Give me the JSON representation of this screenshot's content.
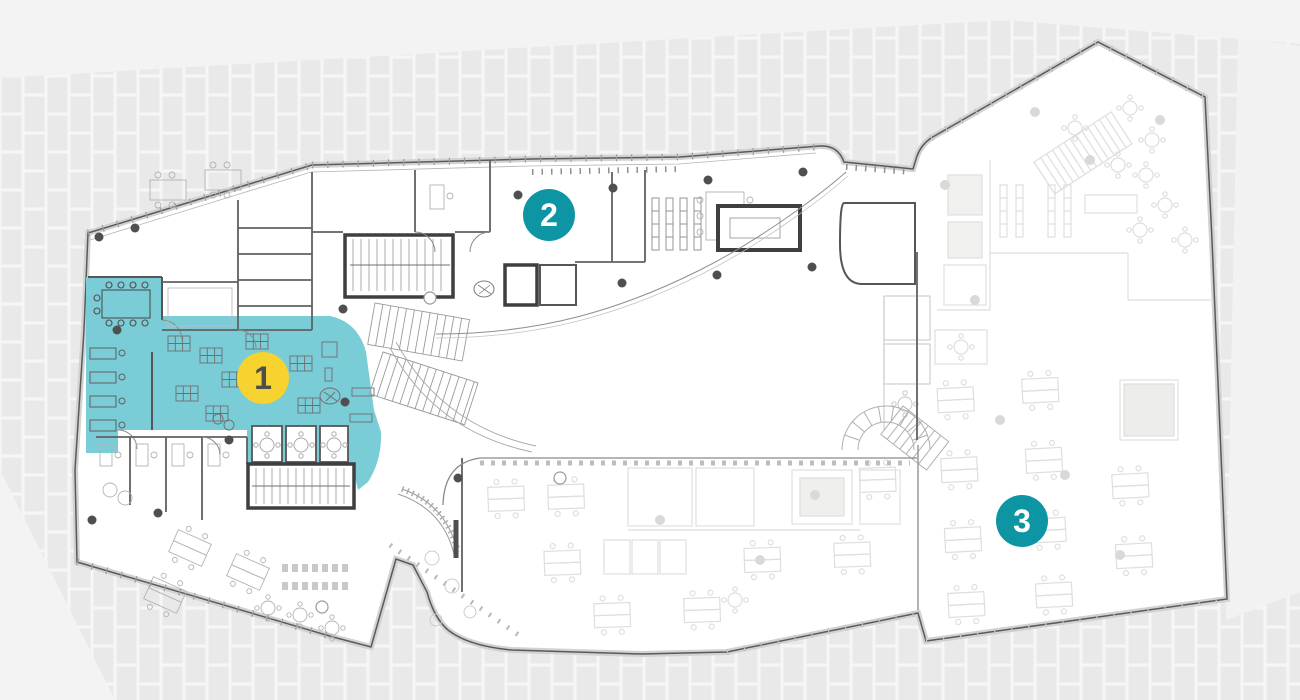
{
  "plan": {
    "title": "office-building-floor-plan",
    "markers": [
      {
        "id": "1",
        "label": "1",
        "fill": "#f6d32e",
        "text_color": "#4d4d4d",
        "x": 263,
        "y": 378
      },
      {
        "id": "2",
        "label": "2",
        "fill": "#0e95a4",
        "text_color": "#ffffff",
        "x": 549,
        "y": 215
      },
      {
        "id": "3",
        "label": "3",
        "fill": "#0e95a4",
        "text_color": "#ffffff",
        "x": 1022,
        "y": 521
      }
    ],
    "colors": {
      "highlight_zone": "#7accd6",
      "marker_yellow": "#f6d32e",
      "marker_teal": "#0e95a4",
      "background": "#f3f3f3",
      "wall_dark": "#4f4f4f"
    }
  }
}
